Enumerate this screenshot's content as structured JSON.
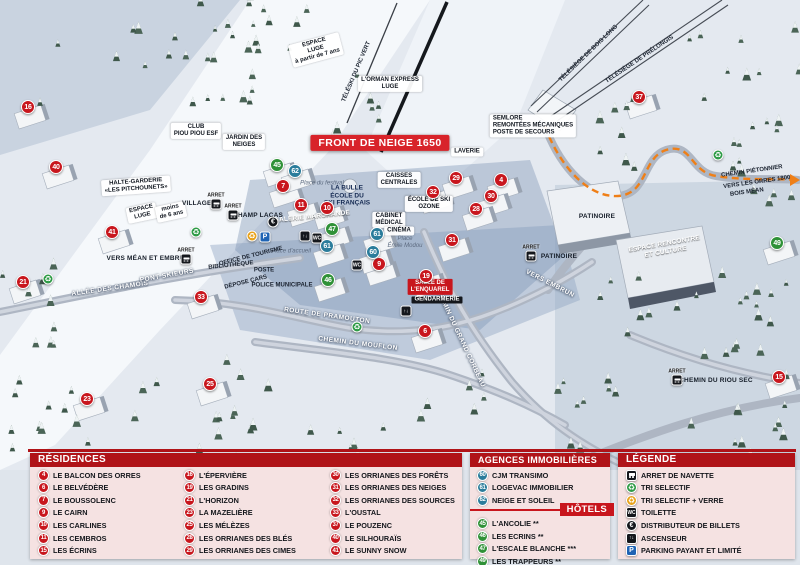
{
  "banner": "FRONT DE NEIGE 1650",
  "arret_label": "ARRET",
  "colors": {
    "residence": "#c8161d",
    "agence": "#2a7c9b",
    "hotel": "#2f9137",
    "header": "#b01318",
    "banner_bg": "#d8232a",
    "orange_path": "#ef7f17"
  },
  "icon_defs": {
    "navette": {
      "name": "bus-stop-icon",
      "shape": "square",
      "bg": "#14171c",
      "glyph": ""
    },
    "tri": {
      "name": "recycle-icon",
      "shape": "circle",
      "bg": "#2e9b46",
      "glyph": "♻"
    },
    "tri_verre": {
      "name": "recycle-glass-icon",
      "shape": "circle",
      "bg": "#e8a21a",
      "glyph": "♻"
    },
    "toilette": {
      "name": "toilet-icon",
      "shape": "square",
      "bg": "#14171c",
      "glyph": "WC"
    },
    "billets": {
      "name": "atm-euro-icon",
      "shape": "circle",
      "bg": "#14171c",
      "glyph": "€"
    },
    "ascenseur": {
      "name": "elevator-icon",
      "shape": "square",
      "bg": "#14171c",
      "glyph": "↑↓"
    },
    "parking": {
      "name": "parking-icon",
      "shape": "square",
      "bg": "#1e63b4",
      "glyph": "P"
    }
  },
  "map": {
    "markers": [
      {
        "n": "16",
        "type": "residence",
        "x": 28,
        "y": 107
      },
      {
        "n": "40",
        "type": "residence",
        "x": 56,
        "y": 167
      },
      {
        "n": "41",
        "type": "residence",
        "x": 112,
        "y": 232
      },
      {
        "n": "21",
        "type": "residence",
        "x": 23,
        "y": 282
      },
      {
        "n": "33",
        "type": "residence",
        "x": 201,
        "y": 297
      },
      {
        "n": "23",
        "type": "residence",
        "x": 87,
        "y": 399
      },
      {
        "n": "25",
        "type": "residence",
        "x": 210,
        "y": 384
      },
      {
        "n": "7",
        "type": "residence",
        "x": 283,
        "y": 186
      },
      {
        "n": "11",
        "type": "residence",
        "x": 301,
        "y": 205
      },
      {
        "n": "10",
        "type": "residence",
        "x": 327,
        "y": 208
      },
      {
        "n": "9",
        "type": "residence",
        "x": 379,
        "y": 264
      },
      {
        "n": "32",
        "type": "residence",
        "x": 433,
        "y": 192
      },
      {
        "n": "29",
        "type": "residence",
        "x": 456,
        "y": 178
      },
      {
        "n": "4",
        "type": "residence",
        "x": 501,
        "y": 180
      },
      {
        "n": "30",
        "type": "residence",
        "x": 491,
        "y": 196
      },
      {
        "n": "28",
        "type": "residence",
        "x": 476,
        "y": 209
      },
      {
        "n": "31",
        "type": "residence",
        "x": 452,
        "y": 240
      },
      {
        "n": "19",
        "type": "residence",
        "x": 426,
        "y": 276
      },
      {
        "n": "6",
        "type": "residence",
        "x": 425,
        "y": 331
      },
      {
        "n": "37",
        "type": "residence",
        "x": 639,
        "y": 97
      },
      {
        "n": "15",
        "type": "residence",
        "x": 779,
        "y": 377
      },
      {
        "n": "45",
        "type": "hotel",
        "x": 277,
        "y": 165
      },
      {
        "n": "47",
        "type": "hotel",
        "x": 332,
        "y": 229
      },
      {
        "n": "46",
        "type": "hotel",
        "x": 328,
        "y": 280
      },
      {
        "n": "49",
        "type": "hotel",
        "x": 777,
        "y": 243
      },
      {
        "n": "62",
        "type": "agence",
        "x": 295,
        "y": 171
      },
      {
        "n": "61",
        "type": "agence",
        "x": 327,
        "y": 246
      },
      {
        "n": "61",
        "type": "agence",
        "x": 377,
        "y": 234
      },
      {
        "n": "60",
        "type": "agence",
        "x": 373,
        "y": 252
      }
    ],
    "labels": [
      {
        "t": "FRONT DE NEIGE 1650",
        "x": 380,
        "y": 143,
        "s": "banner"
      },
      {
        "t": "L'ORMAN EXPRESS\nLUGE",
        "x": 390,
        "y": 84,
        "s": "box"
      },
      {
        "t": "ESPACE\nLUGE\nà partir de 7 ans",
        "x": 316,
        "y": 50,
        "r": -15,
        "s": "box"
      },
      {
        "t": "TÉLÉSKI DU PIC VERT",
        "x": 357,
        "y": 72,
        "r": -67,
        "s": "tiny"
      },
      {
        "t": "TÉLÉSIÈGE DE BOIS LONG",
        "x": 589,
        "y": 54,
        "r": -44,
        "s": "tiny"
      },
      {
        "t": "TÉLÉSIÈGE DE PRÉLONGIS",
        "x": 640,
        "y": 60,
        "r": -34,
        "s": "tiny"
      },
      {
        "t": "CLUB\nPIOU PIOU ESF",
        "x": 196,
        "y": 131,
        "s": "box"
      },
      {
        "t": "JARDIN DES\nNEIGES",
        "x": 244,
        "y": 142,
        "s": "box"
      },
      {
        "t": "HALTE-GARDERIE\n«LES PITCHOUNETS»",
        "x": 136,
        "y": 186,
        "r": -4,
        "s": "box"
      },
      {
        "t": "ESPACE\nLUGE",
        "x": 142,
        "y": 213,
        "r": -12,
        "s": "box"
      },
      {
        "t": "moins\nde 6 ans",
        "x": 171,
        "y": 212,
        "r": -12,
        "s": "box"
      },
      {
        "t": "SEMLORE\nREMONTÉES MÉCANIQUES\nPOSTE DE SECOURS",
        "x": 533,
        "y": 126,
        "s": "boxl"
      },
      {
        "t": "LAVERIE",
        "x": 467,
        "y": 152,
        "s": "box"
      },
      {
        "t": "CAISSES\nCENTRALES",
        "x": 399,
        "y": 180,
        "s": "box"
      },
      {
        "t": "ÉCOLE DE SKI\nOZONE",
        "x": 429,
        "y": 204,
        "s": "box"
      },
      {
        "t": "CABINET\nMÉDICAL",
        "x": 389,
        "y": 220,
        "s": "box"
      },
      {
        "t": "CINÉMA",
        "x": 399,
        "y": 231,
        "s": "box"
      },
      {
        "t": "LA BULLE\nÉCOLE DU\nSKI FRANÇAIS",
        "x": 347,
        "y": 196,
        "s": "navy"
      },
      {
        "t": "GALERIE MARCHANDE",
        "x": 312,
        "y": 217,
        "r": -6,
        "s": "white"
      },
      {
        "t": "Place du festival",
        "x": 322,
        "y": 184,
        "s": "place"
      },
      {
        "t": "Place d'accueil",
        "x": 291,
        "y": 252,
        "s": "place"
      },
      {
        "t": "Place\nÉmile Modou",
        "x": 405,
        "y": 243,
        "s": "place"
      },
      {
        "t": "OFFICE DE TOURISME",
        "x": 251,
        "y": 257,
        "r": -14,
        "s": "tiny"
      },
      {
        "t": "BIBLIOTHÈQUE",
        "x": 231,
        "y": 266,
        "r": -6,
        "s": "tiny"
      },
      {
        "t": "POSTE",
        "x": 264,
        "y": 271,
        "s": "tiny"
      },
      {
        "t": "DÉPOSE CARS",
        "x": 246,
        "y": 283,
        "r": -14,
        "s": "tiny"
      },
      {
        "t": "POLICE\nMUNICIPALE",
        "x": 282,
        "y": 286,
        "s": "tiny"
      },
      {
        "t": "ALLÉE DES CHAMOIS",
        "x": 110,
        "y": 289,
        "r": -8,
        "s": "road"
      },
      {
        "t": "PONT SKIEURS",
        "x": 167,
        "y": 276,
        "r": -10,
        "s": "road"
      },
      {
        "t": "ROUTE DE PRAMOUTON",
        "x": 327,
        "y": 316,
        "r": 8,
        "s": "road"
      },
      {
        "t": "CHEMIN DU MOUFLON",
        "x": 358,
        "y": 344,
        "r": 7,
        "s": "road"
      },
      {
        "t": "CHEMIN DU GRAND CORBEAU",
        "x": 460,
        "y": 338,
        "r": 65,
        "s": "road"
      },
      {
        "t": "VERS EMBRUN",
        "x": 550,
        "y": 284,
        "r": 27,
        "s": "road"
      },
      {
        "t": "PATINOIRE",
        "x": 597,
        "y": 217,
        "s": "dark"
      },
      {
        "t": "ESPACE RENCONTRE\nET CULTURE",
        "x": 665,
        "y": 248,
        "r": -10,
        "s": "white"
      },
      {
        "t": "SALLE DE\nL'ENQUAREL",
        "x": 430,
        "y": 287,
        "s": "redbox"
      },
      {
        "t": "GENDARMERIE",
        "x": 437,
        "y": 300,
        "s": "blackbox"
      },
      {
        "t": "CHEMIN PIÉTONNIER",
        "x": 752,
        "y": 172,
        "r": -8,
        "s": "tiny"
      },
      {
        "t": "VERS LES ORRES 1800",
        "x": 757,
        "y": 183,
        "r": -8,
        "s": "tiny"
      },
      {
        "t": "BOIS MÉAN",
        "x": 747,
        "y": 193,
        "r": -8,
        "s": "tiny"
      },
      {
        "t": "VERS MÉAN ET EMBRUN",
        "x": 148,
        "y": 259,
        "s": "dark"
      },
      {
        "t": "VILLAGES",
        "x": 199,
        "y": 204,
        "s": "dark"
      },
      {
        "t": "CHAMP LACAS",
        "x": 258,
        "y": 216,
        "s": "dark"
      },
      {
        "t": "PATINOIRE",
        "x": 559,
        "y": 257,
        "s": "dark"
      },
      {
        "t": "CHEMIN DU RIOU SEC",
        "x": 716,
        "y": 381,
        "s": "dark"
      }
    ],
    "icons": [
      {
        "k": "navette",
        "x": 216,
        "y": 204
      },
      {
        "k": "navette",
        "x": 233,
        "y": 215
      },
      {
        "k": "navette",
        "x": 186,
        "y": 259
      },
      {
        "k": "navette",
        "x": 531,
        "y": 256
      },
      {
        "k": "navette",
        "x": 677,
        "y": 380
      },
      {
        "k": "billets",
        "x": 273,
        "y": 222
      },
      {
        "k": "ascenseur",
        "x": 305,
        "y": 236
      },
      {
        "k": "ascenseur",
        "x": 406,
        "y": 311
      },
      {
        "k": "toilette",
        "x": 317,
        "y": 238
      },
      {
        "k": "toilette",
        "x": 357,
        "y": 265
      },
      {
        "k": "tri",
        "x": 48,
        "y": 279
      },
      {
        "k": "tri",
        "x": 196,
        "y": 232
      },
      {
        "k": "tri",
        "x": 357,
        "y": 327
      },
      {
        "k": "tri",
        "x": 718,
        "y": 155
      },
      {
        "k": "tri_verre",
        "x": 252,
        "y": 236
      },
      {
        "k": "parking",
        "x": 265,
        "y": 237
      }
    ]
  },
  "legend": {
    "residences": {
      "title": "RÉSIDENCES",
      "items": [
        {
          "n": "4",
          "label": "LE BALCON DES ORRES"
        },
        {
          "n": "6",
          "label": "LE BELVÉDÈRE"
        },
        {
          "n": "7",
          "label": "LE BOUSSOLENC"
        },
        {
          "n": "9",
          "label": "LE CAIRN"
        },
        {
          "n": "10",
          "label": "LES CARLINES"
        },
        {
          "n": "11",
          "label": "LES CEMBROS"
        },
        {
          "n": "15",
          "label": "LES ÉCRINS"
        },
        {
          "n": "16",
          "label": "L'ÉPERVIÈRE"
        },
        {
          "n": "19",
          "label": "LES GRADINS"
        },
        {
          "n": "21",
          "label": "L'HORIZON"
        },
        {
          "n": "23",
          "label": "LA MAZELIÈRE"
        },
        {
          "n": "25",
          "label": "LES MÉLÈZES"
        },
        {
          "n": "28",
          "label": "LES ORRIANES DES BLÉS"
        },
        {
          "n": "29",
          "label": "LES ORRIANES DES CIMES"
        },
        {
          "n": "30",
          "label": "LES ORRIANES DES FORÊTS"
        },
        {
          "n": "31",
          "label": "LES ORRIANES DES NEIGES"
        },
        {
          "n": "32",
          "label": "LES ORRIANES DES SOURCES"
        },
        {
          "n": "33",
          "label": "L'OUSTAL"
        },
        {
          "n": "37",
          "label": "LE POUZENC"
        },
        {
          "n": "40",
          "label": "LE SILHOURAÏS"
        },
        {
          "n": "41",
          "label": "LE SUNNY SNOW"
        }
      ]
    },
    "agences": {
      "title": "AGENCES IMMOBILIÈRES",
      "items": [
        {
          "n": "60",
          "label": "CJM TRANSIMO"
        },
        {
          "n": "61",
          "label": "LOGEVAC IMMOBILIER"
        },
        {
          "n": "62",
          "label": "NEIGE ET SOLEIL"
        }
      ]
    },
    "hotels": {
      "title": "HÔTELS",
      "items": [
        {
          "n": "45",
          "label": "L'ANCOLIE **"
        },
        {
          "n": "46",
          "label": "LES ECRINS **"
        },
        {
          "n": "47",
          "label": "L'ESCALE BLANCHE ***"
        },
        {
          "n": "49",
          "label": "LES TRAPPEURS **"
        }
      ]
    },
    "legende": {
      "title": "LÉGENDE",
      "items": [
        {
          "icon": "navette",
          "label": "ARRET DE NAVETTE"
        },
        {
          "icon": "tri",
          "label": "TRI SELECTIF"
        },
        {
          "icon": "tri_verre",
          "label": "TRI SELECTIF + VERRE"
        },
        {
          "icon": "toilette",
          "label": "TOILETTE"
        },
        {
          "icon": "billets",
          "label": "DISTRIBUTEUR DE BILLETS"
        },
        {
          "icon": "ascenseur",
          "label": "ASCENSEUR"
        },
        {
          "icon": "parking",
          "label": "PARKING PAYANT ET LIMITÉ"
        }
      ]
    }
  }
}
